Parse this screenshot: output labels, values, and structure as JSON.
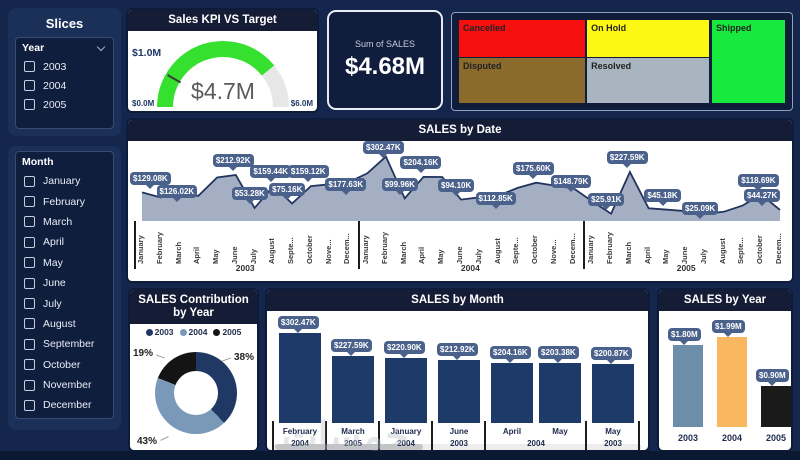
{
  "watermark": "خمسات",
  "sidebar": {
    "title": "Slices",
    "year_slicer": {
      "label": "Year",
      "options": [
        "2003",
        "2004",
        "2005"
      ]
    },
    "month_slicer": {
      "label": "Month",
      "options": [
        "January",
        "February",
        "March",
        "April",
        "May",
        "June",
        "July",
        "August",
        "September",
        "October",
        "November",
        "December"
      ]
    }
  },
  "kpi_gauge": {
    "title": "Sales KPI VS Target",
    "value": 4.7,
    "value_label": "$4.7M",
    "min": 0,
    "min_label": "$0.0M",
    "max": 6,
    "max_label": "$6.0M",
    "target": 1.0,
    "target_label": "$1.0M",
    "arc_color": "#35E02F",
    "track_color": "#E7E7E7"
  },
  "sum_card": {
    "label": "Sum of SALES",
    "value": "$4.68M"
  },
  "treemap": {
    "items": [
      {
        "label": "Cancelled",
        "color": "#F50F0F"
      },
      {
        "label": "On Hold",
        "color": "#FCF813"
      },
      {
        "label": "Disputed",
        "color": "#8A6B2C"
      },
      {
        "label": "Resolved",
        "color": "#A8B5C0"
      },
      {
        "label": "Shipped",
        "color": "#17E93F"
      }
    ]
  },
  "chart_data": [
    {
      "id": "sales_by_date",
      "type": "area",
      "title": "SALES by Date",
      "unit": "K USD",
      "ylim": [
        0,
        310
      ],
      "grid": false,
      "area_fill": "#A4AFC3",
      "line_color": "#23355F",
      "callout_color": "#4A618C",
      "years": [
        "2003",
        "2004",
        "2005"
      ],
      "points": [
        {
          "year": "2003",
          "month": "January",
          "tick": "January",
          "value": 129.08,
          "label": "$129.08K"
        },
        {
          "year": "2003",
          "month": "February",
          "tick": "February",
          "value": 104
        },
        {
          "year": "2003",
          "month": "March",
          "tick": "March",
          "value": 126.02,
          "label": "$126.02K"
        },
        {
          "year": "2003",
          "month": "April",
          "tick": "April",
          "value": 112
        },
        {
          "year": "2003",
          "month": "May",
          "tick": "May",
          "value": 200.87
        },
        {
          "year": "2003",
          "month": "June",
          "tick": "June",
          "value": 212.92,
          "label": "$212.92K"
        },
        {
          "year": "2003",
          "month": "July",
          "tick": "July",
          "value": 53.28,
          "label": "$53.28K"
        },
        {
          "year": "2003",
          "month": "August",
          "tick": "August",
          "value": 159.44,
          "label": "$159.44K"
        },
        {
          "year": "2003",
          "month": "September",
          "tick": "Septe...",
          "value": 75.16,
          "label": "$75.16K"
        },
        {
          "year": "2003",
          "month": "October",
          "tick": "October",
          "value": 159.12,
          "label": "$159.12K"
        },
        {
          "year": "2003",
          "month": "November",
          "tick": "Nove...",
          "value": 168
        },
        {
          "year": "2003",
          "month": "December",
          "tick": "Decem...",
          "value": 177.63,
          "label": "$177.63K"
        },
        {
          "year": "2004",
          "month": "January",
          "tick": "January",
          "value": 220.9
        },
        {
          "year": "2004",
          "month": "February",
          "tick": "February",
          "value": 302.47,
          "label": "$302.47K"
        },
        {
          "year": "2004",
          "month": "March",
          "tick": "March",
          "value": 99.96,
          "label": "$99.96K"
        },
        {
          "year": "2004",
          "month": "April",
          "tick": "April",
          "value": 204.16,
          "label": "$204.16K"
        },
        {
          "year": "2004",
          "month": "May",
          "tick": "May",
          "value": 203.38
        },
        {
          "year": "2004",
          "month": "June",
          "tick": "June",
          "value": 94.1,
          "label": "$94.10K"
        },
        {
          "year": "2004",
          "month": "July",
          "tick": "July",
          "value": 105
        },
        {
          "year": "2004",
          "month": "August",
          "tick": "August",
          "value": 112.85,
          "label": "$112.85K"
        },
        {
          "year": "2004",
          "month": "September",
          "tick": "Septe...",
          "value": 150
        },
        {
          "year": "2004",
          "month": "October",
          "tick": "October",
          "value": 175.6,
          "label": "$175.60K"
        },
        {
          "year": "2004",
          "month": "November",
          "tick": "Nove...",
          "value": 162
        },
        {
          "year": "2004",
          "month": "December",
          "tick": "Decem...",
          "value": 148.79,
          "label": "$148.79K"
        },
        {
          "year": "2005",
          "month": "January",
          "tick": "January",
          "value": 85
        },
        {
          "year": "2005",
          "month": "February",
          "tick": "February",
          "value": 25.91,
          "label": "$25.91K"
        },
        {
          "year": "2005",
          "month": "March",
          "tick": "March",
          "value": 227.59,
          "label": "$227.59K"
        },
        {
          "year": "2005",
          "month": "April",
          "tick": "April",
          "value": 52
        },
        {
          "year": "2005",
          "month": "May",
          "tick": "May",
          "value": 45.18,
          "label": "$45.18K"
        },
        {
          "year": "2005",
          "month": "June",
          "tick": "June",
          "value": 38
        },
        {
          "year": "2005",
          "month": "July",
          "tick": "July",
          "value": 25.09,
          "label": "$25.09K"
        },
        {
          "year": "2005",
          "month": "August",
          "tick": "August",
          "value": 35
        },
        {
          "year": "2005",
          "month": "September",
          "tick": "Septe...",
          "value": 65
        },
        {
          "year": "2005",
          "month": "October",
          "tick": "October",
          "value": 118.69,
          "label": "$118.69K"
        },
        {
          "year": "2005",
          "month": "December",
          "tick": "Decem...",
          "value": 44.27,
          "label": "$44.27K"
        }
      ]
    },
    {
      "id": "sales_contribution_by_year",
      "type": "donut",
      "title": "SALES Contribution by Year",
      "legend_position": "top",
      "slices": [
        {
          "year": "2003",
          "pct": 38,
          "pct_label": "38%",
          "color": "#1F3864"
        },
        {
          "year": "2004",
          "pct": 43,
          "pct_label": "43%",
          "color": "#7A99B8"
        },
        {
          "year": "2005",
          "pct": 19,
          "pct_label": "19%",
          "color": "#141414"
        }
      ]
    },
    {
      "id": "sales_by_month",
      "type": "bar",
      "title": "SALES by Month",
      "ylim": [
        0,
        310
      ],
      "bar_color": "#1E3A68",
      "groups": [
        {
          "year": "2004",
          "bars": [
            {
              "month": "February",
              "value": 302.47,
              "label": "$302.47K"
            }
          ]
        },
        {
          "year": "2005",
          "bars": [
            {
              "month": "March",
              "value": 227.59,
              "label": "$227.59K"
            }
          ]
        },
        {
          "year": "2004",
          "bars": [
            {
              "month": "January",
              "value": 220.9,
              "label": "$220.90K"
            }
          ]
        },
        {
          "year": "2003",
          "bars": [
            {
              "month": "June",
              "value": 212.92,
              "label": "$212.92K"
            }
          ]
        },
        {
          "year": "2004",
          "bars": [
            {
              "month": "April",
              "value": 204.16,
              "label": "$204.16K"
            },
            {
              "month": "May",
              "value": 203.38,
              "label": "$203.38K"
            }
          ]
        },
        {
          "year": "2003",
          "bars": [
            {
              "month": "May",
              "value": 200.87,
              "label": "$200.87K"
            }
          ]
        }
      ]
    },
    {
      "id": "sales_by_year",
      "type": "bar",
      "title": "SALES by Year",
      "ylim": [
        0,
        2.2
      ],
      "bars": [
        {
          "year": "2003",
          "value": 1.8,
          "label": "$1.80M",
          "color": "#6C8EA9"
        },
        {
          "year": "2004",
          "value": 1.99,
          "label": "$1.99M",
          "color": "#F9B860"
        },
        {
          "year": "2005",
          "value": 0.9,
          "label": "$0.90M",
          "color": "#1A1A1A"
        }
      ]
    }
  ]
}
